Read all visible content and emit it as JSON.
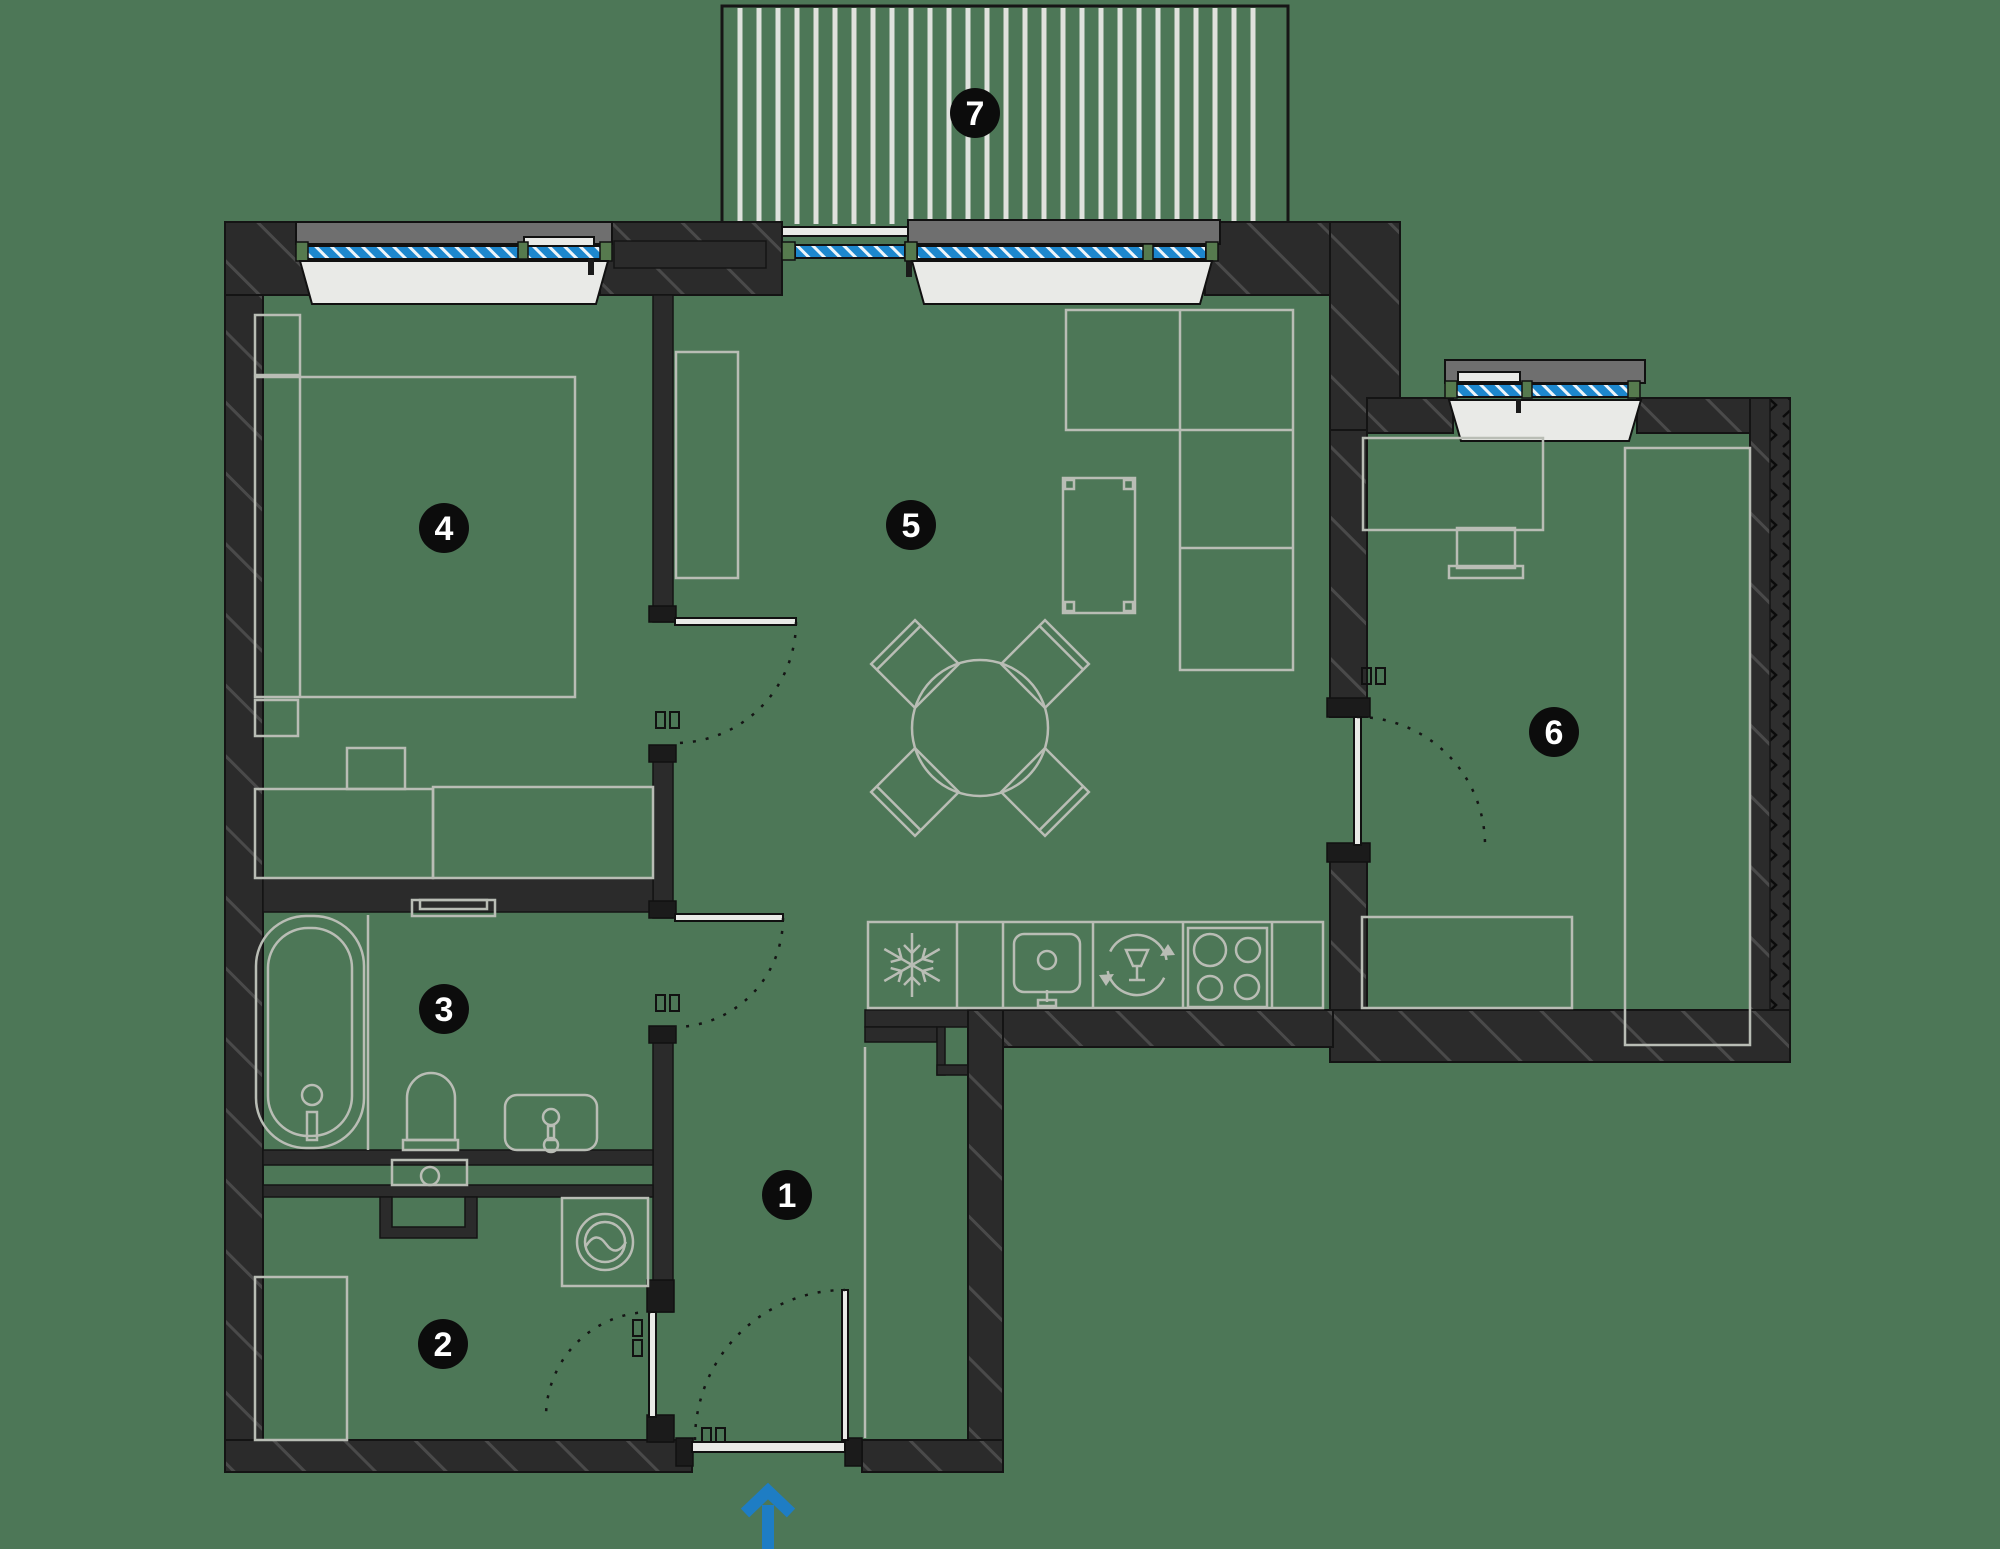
{
  "canvas": {
    "width": 2000,
    "height": 1549,
    "background_color": "#4d7757"
  },
  "palette": {
    "wall_fill": "#2b2b2b",
    "wall_hatch_line": "#4a4a4a",
    "wall_outline": "#141414",
    "furniture_line": "#b9bdb5",
    "window_glass": "#1d87cd",
    "window_glass_hatch": "#eef5fa",
    "exterior_sill": "#6f6f6f",
    "interior_sill": "#e9eae7",
    "frame_block": "#567a4e",
    "balcony_stripe": "#dfe2dd",
    "label_bg": "#0c0c0c",
    "label_text": "#ffffff",
    "entrance_arrow": "#1e7dc4"
  },
  "label_style": {
    "radius": 25,
    "font_size": 34
  },
  "rooms": [
    {
      "number": "1",
      "name": "hallway",
      "label_x": 787,
      "label_y": 1195
    },
    {
      "number": "2",
      "name": "storage-room",
      "label_x": 443,
      "label_y": 1344
    },
    {
      "number": "3",
      "name": "bathroom",
      "label_x": 444,
      "label_y": 1009
    },
    {
      "number": "4",
      "name": "bedroom",
      "label_x": 444,
      "label_y": 528
    },
    {
      "number": "5",
      "name": "living-room-kitchen",
      "label_x": 911,
      "label_y": 525
    },
    {
      "number": "6",
      "name": "bedroom-2",
      "label_x": 1554,
      "label_y": 732
    },
    {
      "number": "7",
      "name": "balcony",
      "label_x": 975,
      "label_y": 113
    }
  ],
  "balcony": {
    "x1": 722,
    "y1": 6,
    "x2": 1288,
    "y2": 226,
    "stripe_spacing": 19,
    "stripe_width": 5,
    "stripe_inset": 18
  },
  "entrance": {
    "symbol": "arrow-up",
    "x": 768,
    "tip_y": 1491,
    "tail_y": 1549
  },
  "fixtures": [
    "bathtub",
    "toilet",
    "washbasin",
    "towel-shelf",
    "washing-machine",
    "wardrobe",
    "bed",
    "nightstand",
    "bench",
    "sofa",
    "coffee-table",
    "dining-table",
    "dining-chair",
    "desk",
    "desk-chair",
    "dresser",
    "kitchen-counter",
    "freezer",
    "kitchen-sink",
    "dishwasher",
    "cooktop",
    "duct-shaft"
  ]
}
